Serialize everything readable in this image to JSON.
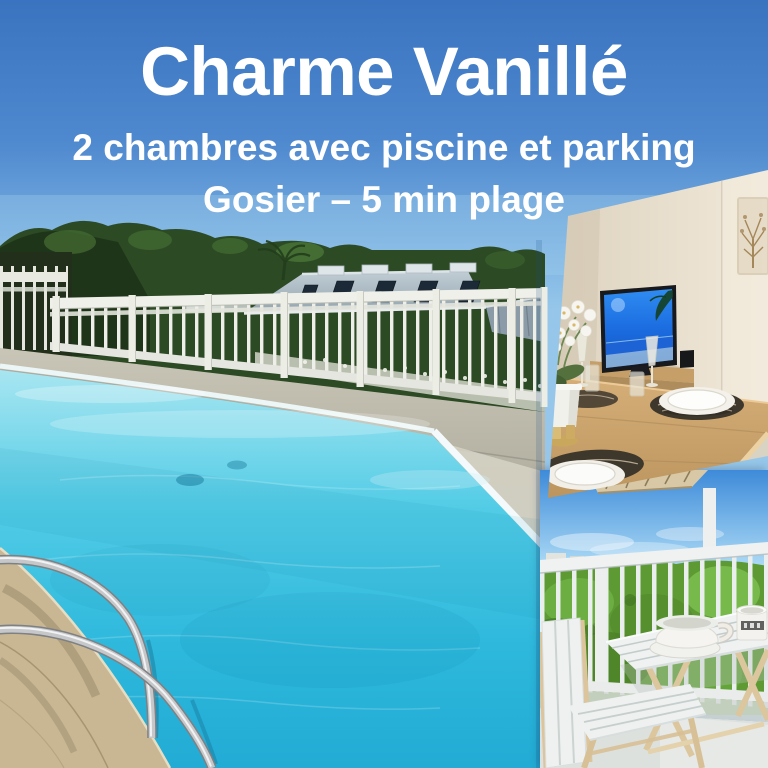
{
  "overlay": {
    "title": "Charme Vanillé",
    "subtitle": "2 chambres avec piscine et parking",
    "location": "Gosier – 5 min plage"
  },
  "photos": {
    "pool": {
      "label": "swimming pool with white railing"
    },
    "dining": {
      "label": "dining room with TV"
    },
    "balcony": {
      "label": "balcony with table and chair"
    }
  },
  "colors": {
    "sky_top": "#3a74c0",
    "sky_light": "#8fc2e8",
    "pool_water": "#2bb8dc",
    "text": "#ffffff"
  }
}
